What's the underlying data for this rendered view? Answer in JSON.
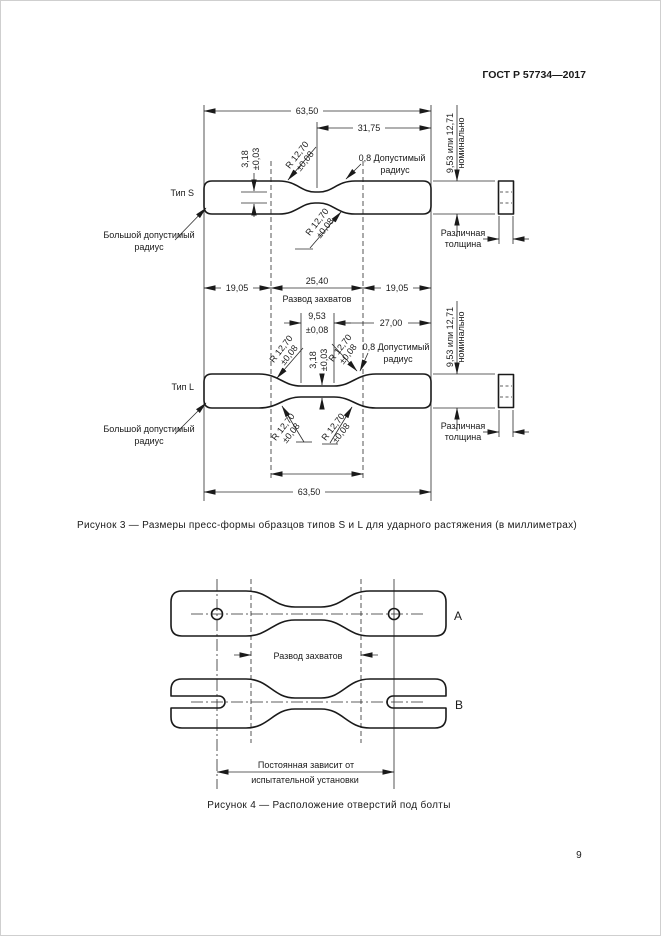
{
  "header": {
    "doc_number": "ГОСТ Р 57734—2017"
  },
  "fig3": {
    "caption": "Рисунок 3 — Размеры пресс-формы образцов типов S и L для ударного растяжения (в миллиметрах)",
    "type_s": "Тип S",
    "type_l": "Тип L",
    "dim_overall": "63,50",
    "dim_half": "31,75",
    "dim_jaw": "25,40",
    "jaw_label": "Развод захватов",
    "dim_grip": "19,05",
    "dim_27": "27,00",
    "neck_len": {
      "v": "9,53",
      "tol": "±0,08"
    },
    "neck_width": {
      "v": "3,18",
      "tol": "±0,03"
    },
    "radius": {
      "v": "R 12,70",
      "tol": "±0,08"
    },
    "thickness_dim": {
      "line1": "9,53 или 12,71",
      "line2": "номинально"
    },
    "allow_radius": {
      "line1": "0,8 Допустимый",
      "line2": "радиус"
    },
    "big_radius": {
      "line1": "Большой допустимый",
      "line2": "радиус"
    },
    "var_thickness": {
      "line1": "Различная",
      "line2": "толщина"
    }
  },
  "fig4": {
    "caption": "Рисунок 4 — Расположение отверстий под болты",
    "label_a": "А",
    "label_b": "В",
    "jaw_label": "Развод захватов",
    "const_line1": "Постоянная зависит от",
    "const_line2": "испытательной установки"
  },
  "page": {
    "number": "9"
  }
}
